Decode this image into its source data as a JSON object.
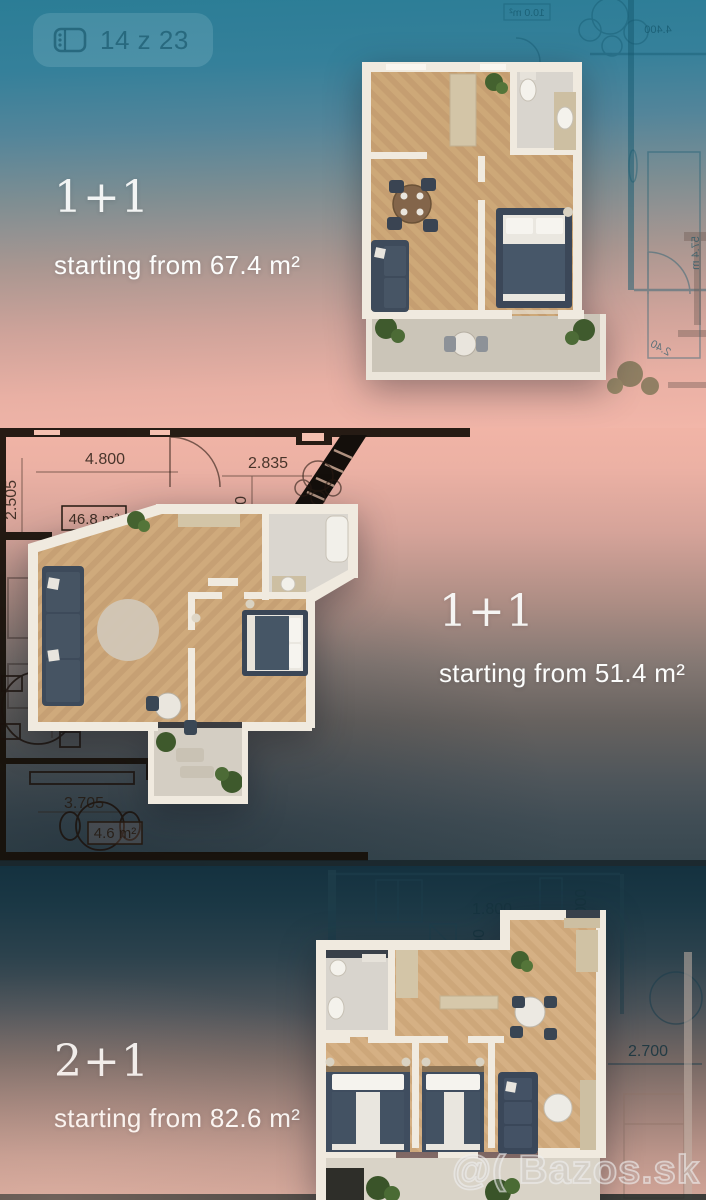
{
  "photo_counter": {
    "label": "14 z 23"
  },
  "sections": {
    "top": {
      "plan_type": "1+1",
      "area_text": "starting from 67.4 m²"
    },
    "middle": {
      "plan_type": "1+1",
      "area_text": "starting from 51.4 m²"
    },
    "bottom": {
      "plan_type": "2+1",
      "area_text": "starting from 82.6 m²"
    }
  },
  "blueprint": {
    "top": {
      "room_area": "10.0 m²",
      "dim_width": "4.400",
      "dim_side": "57.4 m",
      "dim_small": "2.40"
    },
    "middle": {
      "dim_top_left": "4.800",
      "dim_top_right": "2.835",
      "dim_left_upper": "2.505",
      "dim_inner": "2.800",
      "area_main": "46.8 m²",
      "dim_mid": "3.600",
      "dim_left_lower": "5.900",
      "dim_bottom": "3.705",
      "area_balcony": "4.6 m²"
    },
    "bottom": {
      "dim_top": "1.800",
      "dim_right": "2.700",
      "dim_vert_a": "000",
      "dim_vert_b": "00"
    }
  },
  "watermark": {
    "text": "@( Bazos.sk"
  }
}
